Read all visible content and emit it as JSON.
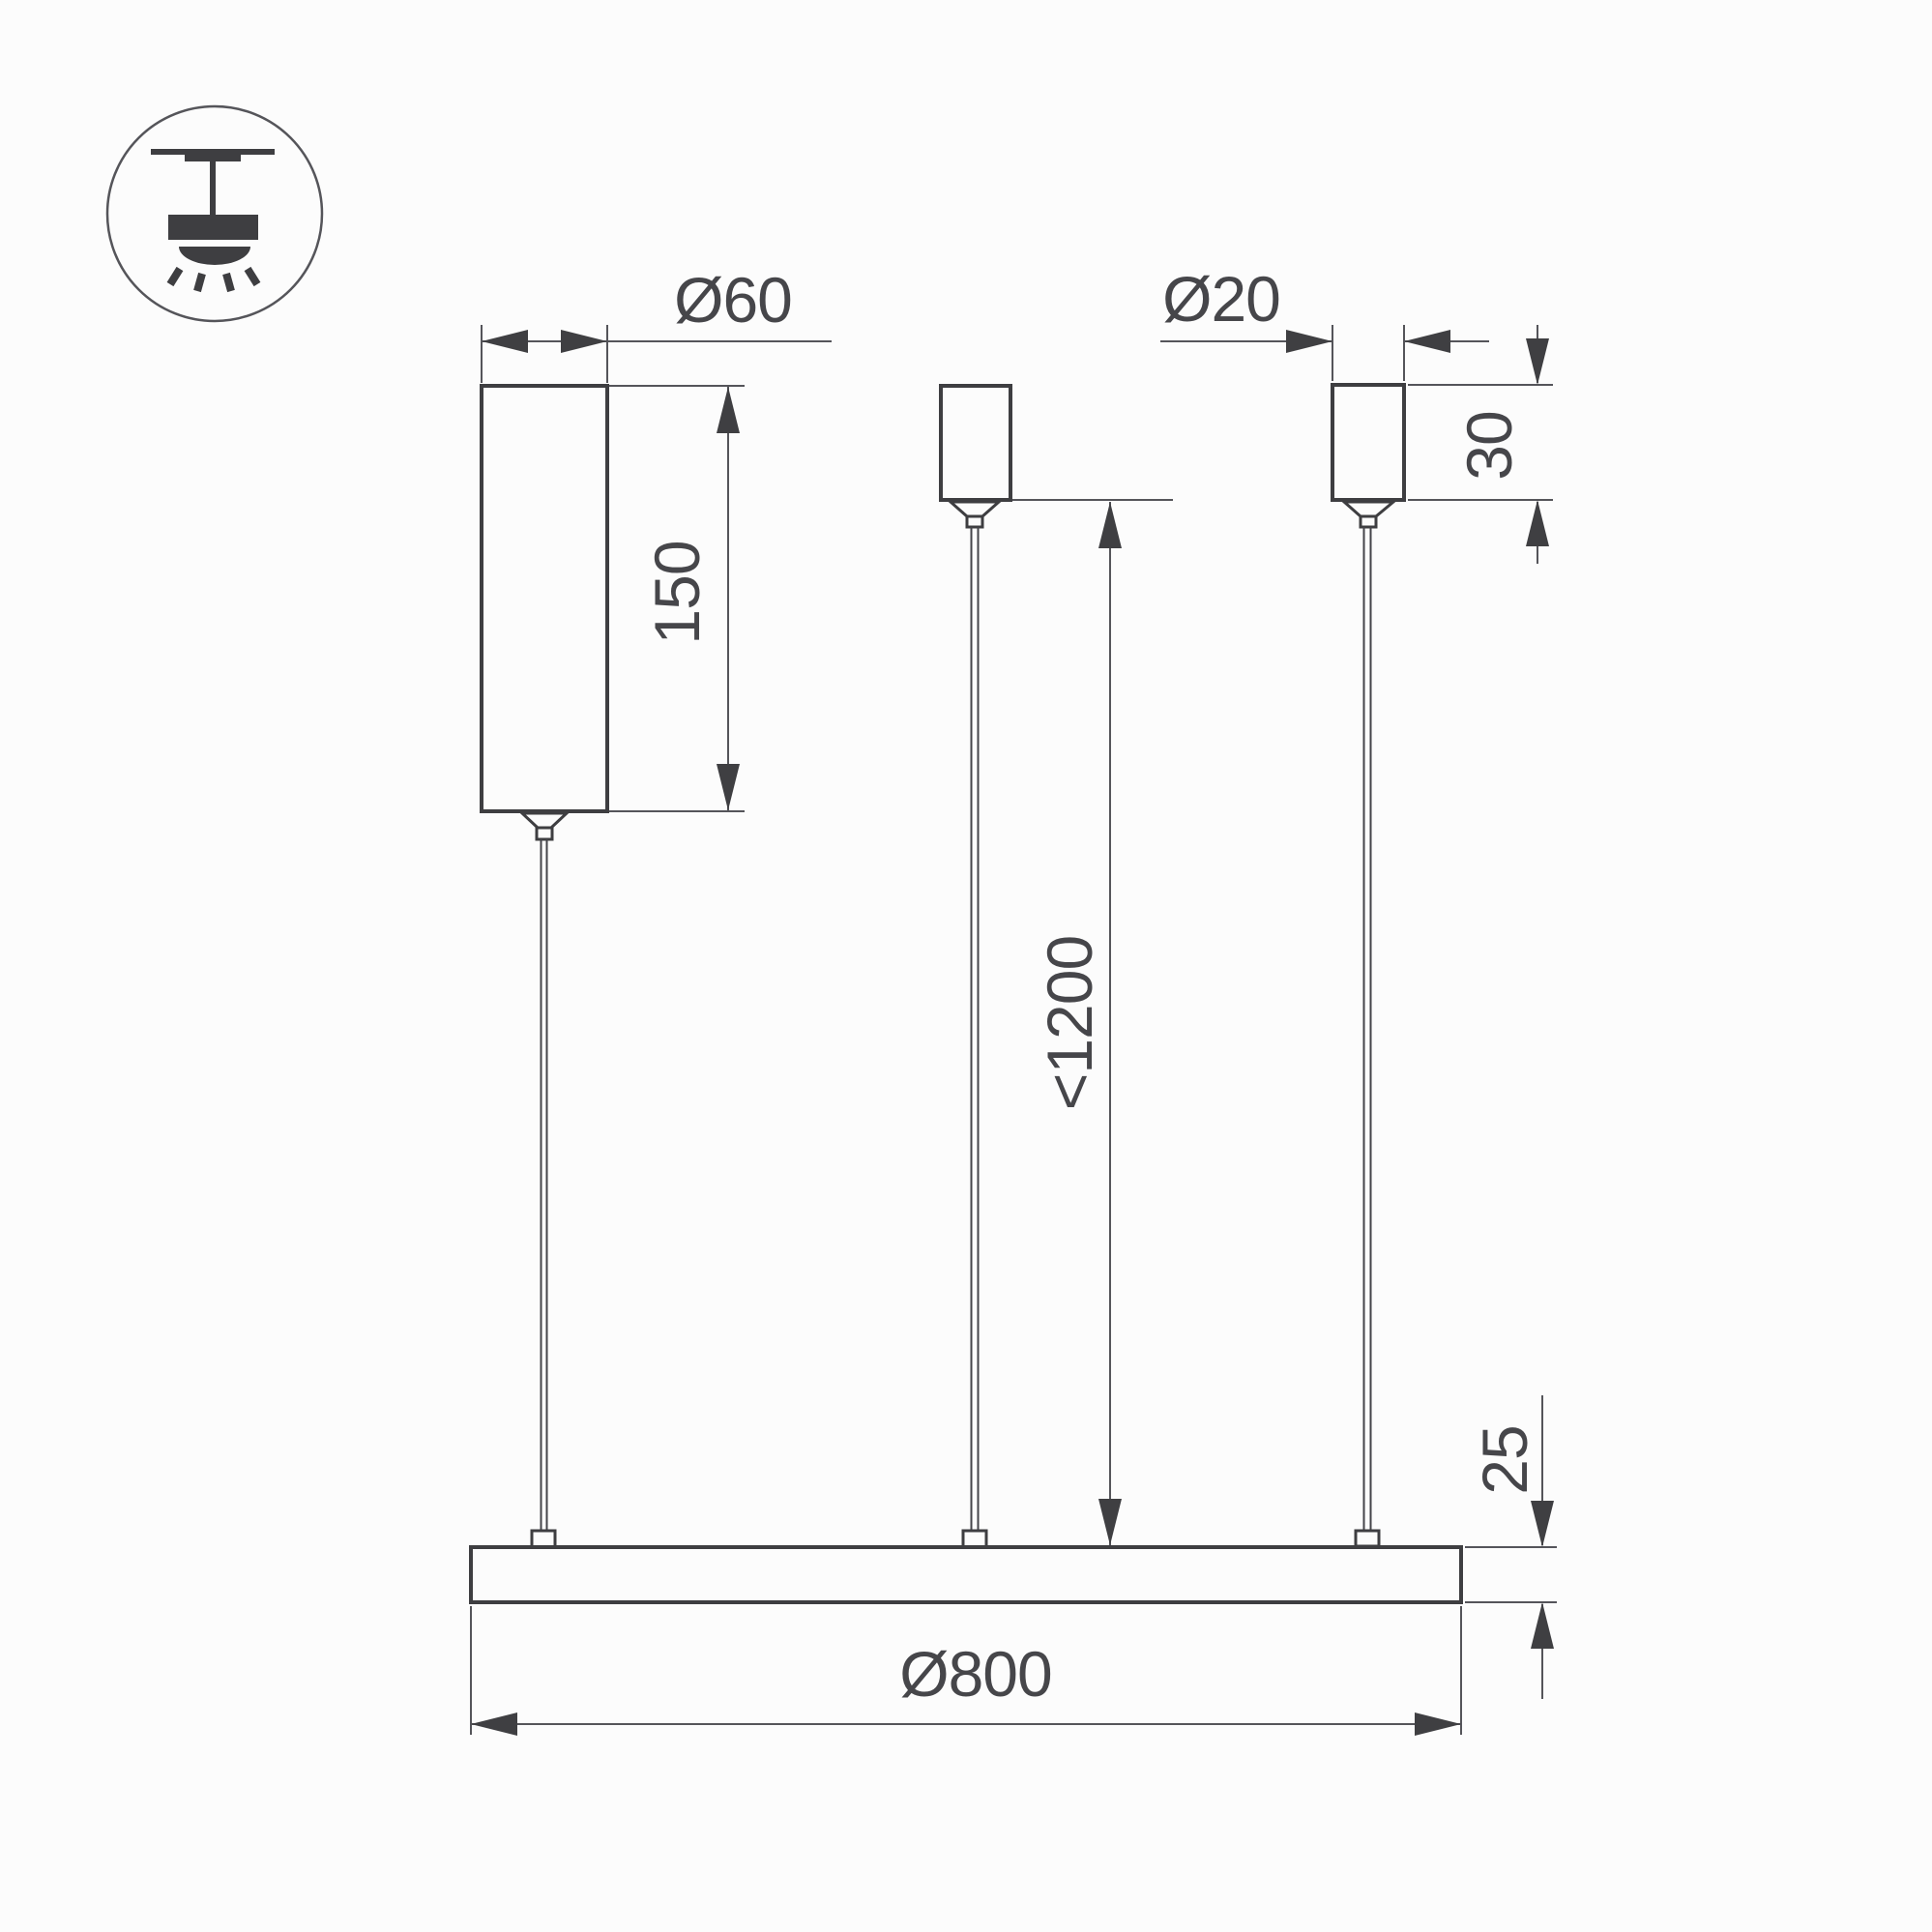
{
  "page": {
    "background": "#fcfcfc"
  },
  "drawing": {
    "type_icon": "pendant-light-icon",
    "labels": {
      "canopy_diameter": "Ø60",
      "canopy_height": "150",
      "grip_diameter": "Ø20",
      "grip_height": "30",
      "suspension_max_length": "<1200",
      "profile_thickness": "25",
      "fixture_diameter": "Ø800"
    },
    "colors": {
      "body_line": "#3e3e41",
      "dimension_line": "#55555a",
      "text": "#46464a",
      "background": "#fcfcfc"
    }
  }
}
